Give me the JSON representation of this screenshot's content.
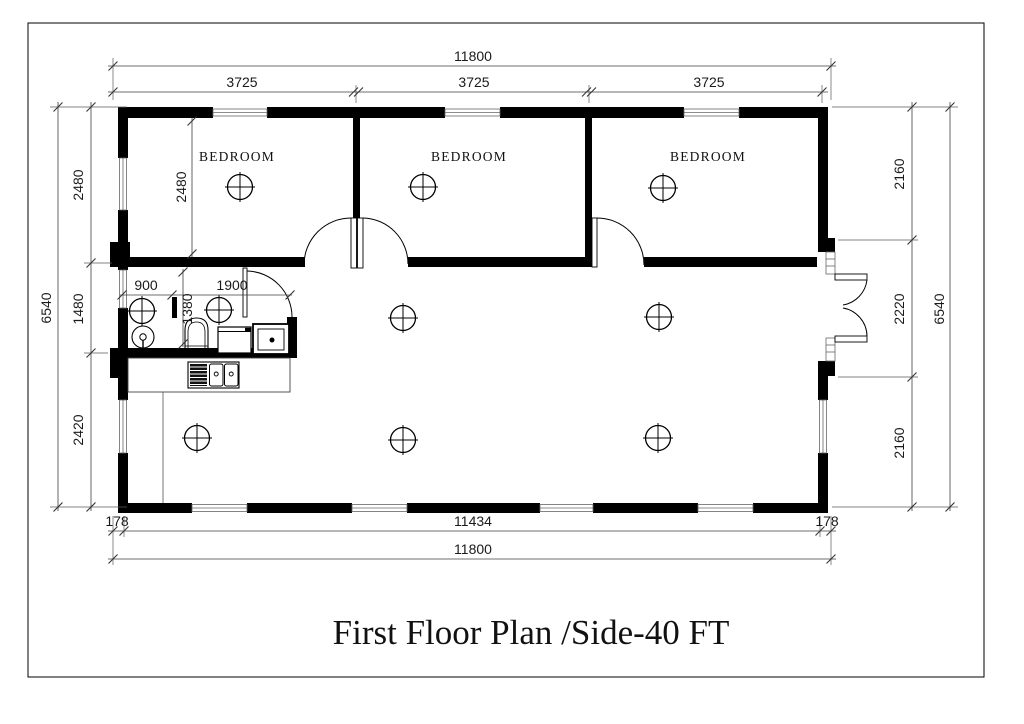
{
  "title": {
    "text": "First Floor Plan /Side-40 FT"
  },
  "rooms": {
    "bedroom1": "BEDROOM",
    "bedroom2": "BEDROOM",
    "bedroom3": "BEDROOM"
  },
  "dimensions": {
    "top_overall": "11800",
    "top_segments": [
      "3725",
      "3725",
      "3725"
    ],
    "bottom_left": "178",
    "bottom_middle": "11434",
    "bottom_right": "178",
    "bottom_overall": "11800",
    "left_overall": "6540",
    "left_segments": [
      "2480",
      "1480",
      "2420"
    ],
    "right_segments": [
      "2160",
      "2220",
      "2160"
    ],
    "right_overall": "6540",
    "bedroom1_depth": "2480",
    "bath_shower_width": "900",
    "bath_main_width": "1900",
    "bath_depth": "1380"
  },
  "colors": {
    "wall": "#000000",
    "background": "#ffffff",
    "dimension_line": "#3f3f3f",
    "text": "#1a1a1a"
  },
  "fixtures": {
    "lights": "ceiling-light",
    "shower": "shower-head",
    "toilet": "toilet",
    "washer": "washing-machine",
    "vanity": "vanity-sink",
    "kitchen_sink": "kitchen-sink",
    "counter": "kitchen-counter"
  }
}
